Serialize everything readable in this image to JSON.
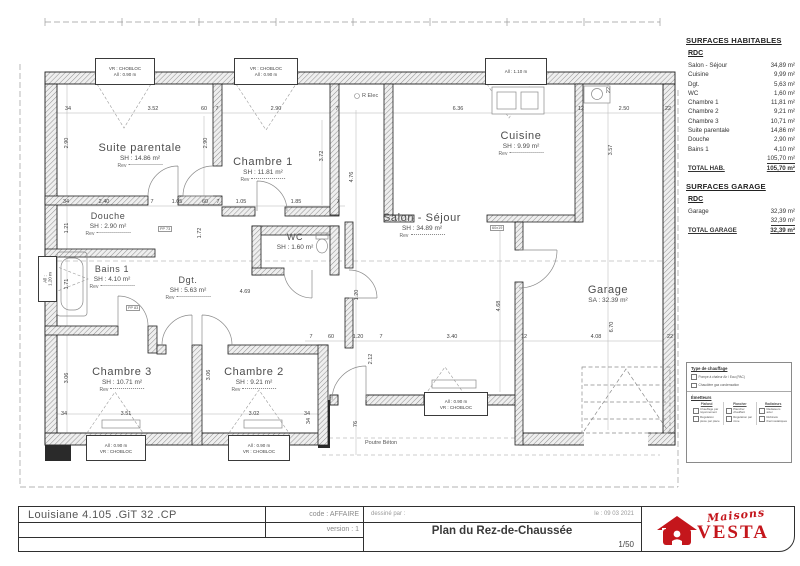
{
  "rooms": {
    "suite": {
      "name": "Suite parentale",
      "sh": "SH : 14.86 m²",
      "rev": "Rev"
    },
    "ch1": {
      "name": "Chambre 1",
      "sh": "SH : 11.81 m²",
      "rev": "Rev"
    },
    "cuisine": {
      "name": "Cuisine",
      "sh": "SH : 9.99 m²",
      "rev": "Rev"
    },
    "douche": {
      "name": "Douche",
      "sh": "SH : 2.90 m²",
      "rev": "Rev"
    },
    "wc": {
      "name": "WC",
      "sh": "SH : 1.60 m²"
    },
    "salon": {
      "name": "Salon - Séjour",
      "sh": "SH : 34.89 m²",
      "rev": "Rev"
    },
    "bains": {
      "name": "Bains 1",
      "sh": "SH : 4.10 m²",
      "rev": "Rev"
    },
    "dgt": {
      "name": "Dgt.",
      "sh": "SH : 5.63 m²",
      "rev": "Rev"
    },
    "ch3": {
      "name": "Chambre 3",
      "sh": "SH : 10.71 m²",
      "rev": "Rev"
    },
    "ch2": {
      "name": "Chambre 2",
      "sh": "SH : 9.21 m²",
      "rev": "Rev"
    },
    "garage": {
      "name": "Garage",
      "sh": "SA : 32.39 m²"
    }
  },
  "dims": {
    "n7": "7",
    "n12": "12",
    "n22": "22",
    "n34": "34",
    "n60": "60",
    "n76": "76",
    "d105": "1.05",
    "d120": "1.20",
    "d121": "1.21",
    "d171": "1.71",
    "d172": "1.72",
    "d185": "1.85",
    "d212": "2.12",
    "d240": "2.40",
    "d250": "2.50",
    "d290": "2.90",
    "d302": "3.02",
    "d306": "3.06",
    "d340": "3.40",
    "d351": "3.51",
    "d352": "3.52",
    "d357": "3.57",
    "d372": "3.72",
    "d408": "4.08",
    "d468": "4.68",
    "d469": "4.69",
    "d476": "4.76",
    "d636": "6.36",
    "d670": "6.70"
  },
  "openings": {
    "vr": "VR : CHOBLOC",
    "all090": "All : 0.90 m",
    "all110": "All : 1.10 m",
    "all120": "All : 1.20 m",
    "pp73": "PP 73",
    "pp83": "PP 83",
    "tag6019": "60x19"
  },
  "notes": {
    "relec": "R Elec",
    "poutre": "Poutre Béton"
  },
  "surfaces": {
    "title": "SURFACES HABITABLES",
    "floor": "RDC",
    "rows": [
      {
        "label": "Salon - Séjour",
        "value": "34,89 m²"
      },
      {
        "label": "Cuisine",
        "value": "9,99 m²"
      },
      {
        "label": "Dgt.",
        "value": "5,63 m²"
      },
      {
        "label": "WC",
        "value": "1,60 m²"
      },
      {
        "label": "Chambre 1",
        "value": "11,81 m²"
      },
      {
        "label": "Chambre 2",
        "value": "9,21 m²"
      },
      {
        "label": "Chambre 3",
        "value": "10,71 m²"
      },
      {
        "label": "Suite parentale",
        "value": "14,86 m²"
      },
      {
        "label": "Douche",
        "value": "2,90 m²"
      },
      {
        "label": "Bains 1",
        "value": "4,10 m²"
      }
    ],
    "subtotal": "105,70 m²",
    "total_label": "TOTAL HAB.",
    "total_value": "105,70 m²"
  },
  "garage_surfaces": {
    "title": "SURFACES GARAGE",
    "floor": "RDC",
    "rows": [
      {
        "label": "Garage",
        "value": "32,39 m²"
      }
    ],
    "subtotal": "32,39 m²",
    "total_label": "TOTAL GARAGE",
    "total_value": "32,39 m²"
  },
  "legend": {
    "heat_title": "Type de chauffage",
    "heat_items": [
      "Pompe à chaleur Air / Eau (PAC)",
      "Chaudière gaz condensation"
    ],
    "emit_title": "Émetteurs",
    "cols": [
      {
        "h": "Plafond",
        "items": [
          "Chauffage par rayonnement",
          "Régulation pièce par pièce"
        ]
      },
      {
        "h": "Plancher",
        "items": [
          "Plancher chauffant",
          "Régulation par zone"
        ]
      },
      {
        "h": "Radiateurs",
        "items": [
          "Radiateurs acier",
          "Robinets thermostatiques"
        ]
      }
    ]
  },
  "titleblock": {
    "project": "Louisiane 4.105 .GiT 32 .CP",
    "code": "code : AFFAIRE",
    "version": "version : 1",
    "drawn_by": "dessiné par :",
    "date": "le : 09 03 2021",
    "title": "Plan du Rez-de-Chaussée",
    "scale": "1/50"
  },
  "logo": {
    "script": "Maisons",
    "brand": "VESTA",
    "color": "#c4161c"
  }
}
